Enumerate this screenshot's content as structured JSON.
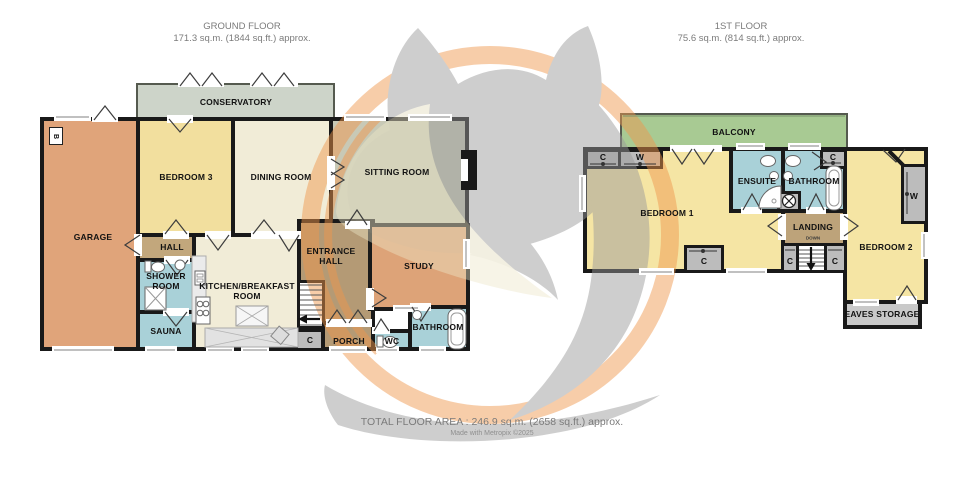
{
  "floors": {
    "ground": {
      "title": "GROUND FLOOR",
      "area": "171.3 sq.m. (1844 sq.ft.) approx.",
      "rooms": {
        "garage": "GARAGE",
        "bedroom3": "BEDROOM 3",
        "dining": "DINING ROOM",
        "conservatory": "CONSERVATORY",
        "sitting": "SITTING ROOM",
        "hall": "HALL",
        "shower": "SHOWER ROOM",
        "sauna": "SAUNA",
        "kitchen": "KITCHEN/BREAKFAST ROOM",
        "entrance": "ENTRANCE HALL",
        "study": "STUDY",
        "bathroom": "BATHROOM",
        "wc": "WC",
        "porch": "PORCH"
      },
      "markers": {
        "cupboard": "C",
        "b": "B"
      }
    },
    "first": {
      "title": "1ST FLOOR",
      "area": "75.6 sq.m. (814 sq.ft.) approx.",
      "rooms": {
        "balcony": "BALCONY",
        "bedroom1": "BEDROOM 1",
        "ensuite": "ENSUITE",
        "bathroom": "BATHROOM",
        "landing": "LANDING",
        "bedroom2": "BEDROOM 2",
        "eaves": "EAVES STORAGE"
      },
      "markers": {
        "cupboard": "C",
        "wardrobe": "W",
        "stairs_direction": "DOWN"
      }
    }
  },
  "footer": {
    "total_area": "TOTAL FLOOR AREA : 246.9 sq.m. (2658 sq.ft.) approx.",
    "credit": "Made with Metropix ©2025"
  },
  "colors": {
    "wall": "#191919",
    "room_orange": "#e0a47a",
    "room_yellow": "#f5e5a4",
    "room_cream": "#f1ecd7",
    "room_blue": "#a9d1d8",
    "room_brown": "#b49a75",
    "conservatory_green": "#cdd4c9",
    "sitting_olive": "#c8c9b6",
    "balcony_green": "#a8ca93",
    "closet_gray": "#bcbcbc",
    "watermark_orange": "#f0974d",
    "watermark_gray": "#9a9a9a"
  }
}
